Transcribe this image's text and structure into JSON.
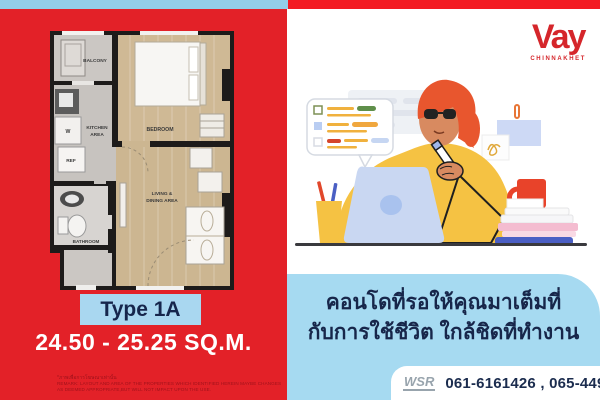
{
  "brand": {
    "name": "Vay",
    "location": "CHINNAKHET"
  },
  "floorplan": {
    "labels": {
      "balcony": "BALCONY",
      "washer": "W",
      "kitchen1": "KITCHEN",
      "kitchen2": "AREA",
      "fridge": "REF",
      "bedroom": "BEDROOM",
      "living1": "LIVING &",
      "living2": "DINING AREA",
      "bathroom": "BATHROOM"
    },
    "type_label": "Type 1A",
    "area_range": "24.50 - 25.25 SQ.M."
  },
  "headline": {
    "line1": "คอนโดที่รอให้คุณมาเต็มที่",
    "line2": "กับการใช้ชีวิต ใกล้ชิดที่ทำงาน"
  },
  "disclaimer": {
    "thai": "*ภาพเพื่อการโฆษณาเท่านั้น",
    "english": "REMARK: LAYOUT AND AREA OF THE PROPERTIES WHICH IDENTIFIED HEREIN MAYBE CHANGES AS DEEMED APPROPRIATE,BUT WILL NOT IMPACT UPON THE USE."
  },
  "footer": {
    "agency": "WSR",
    "phones": "061-6161426 , 065-4496399"
  },
  "colors": {
    "red": "#e32128",
    "light_blue": "#a6daf1",
    "navy": "#17264a",
    "yellow": "#f5c243"
  }
}
